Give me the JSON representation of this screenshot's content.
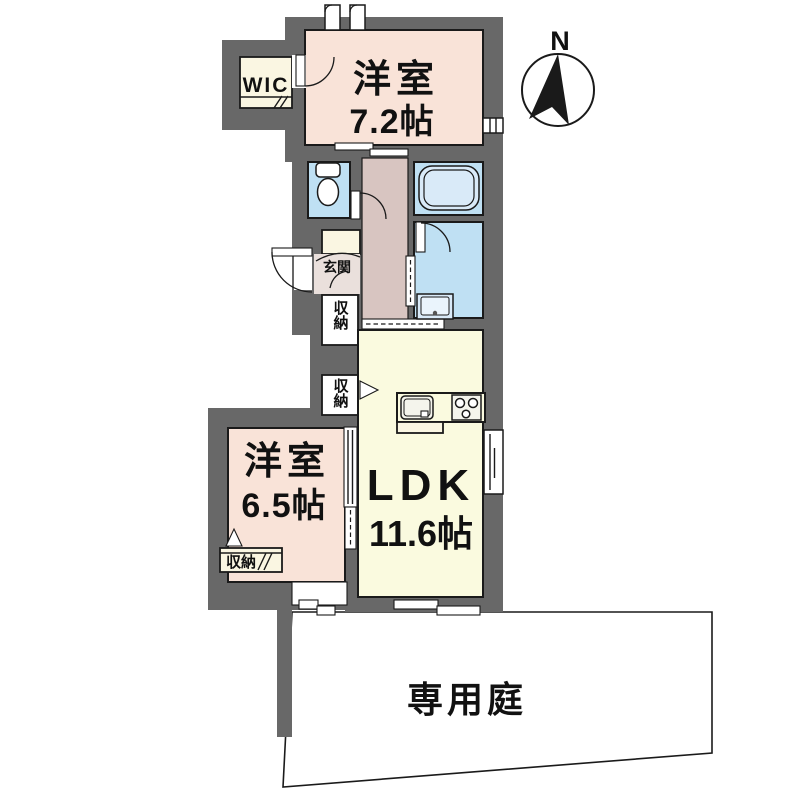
{
  "title": "間取り図",
  "colors": {
    "wall": "#686868",
    "line": "#1a1a1a",
    "text": "#111111",
    "western": "#F9E3D8",
    "ldk": "#FAFADF",
    "wet": "#BFE0F3",
    "hall": "#D8C5C1",
    "genkan": "#EAE0DC",
    "cream": "#FAF6E2",
    "tub": "#D9EAF8",
    "garden": "#FFFFFF"
  },
  "compass": {
    "north_label": "N"
  },
  "rooms": {
    "bedroom1": {
      "name": "洋室",
      "size": "7.2帖"
    },
    "bedroom2": {
      "name": "洋室",
      "size": "6.5帖"
    },
    "ldk": {
      "name": "LDK",
      "size": "11.6帖"
    },
    "wic": {
      "label": "WIC"
    },
    "entrance": {
      "label": "玄関"
    },
    "storage_hall_upper": {
      "label": "収納"
    },
    "storage_hall_lower": {
      "label": "収納"
    },
    "storage_bedroom2": {
      "label": "収納"
    },
    "garden": {
      "label": "専用庭"
    }
  }
}
